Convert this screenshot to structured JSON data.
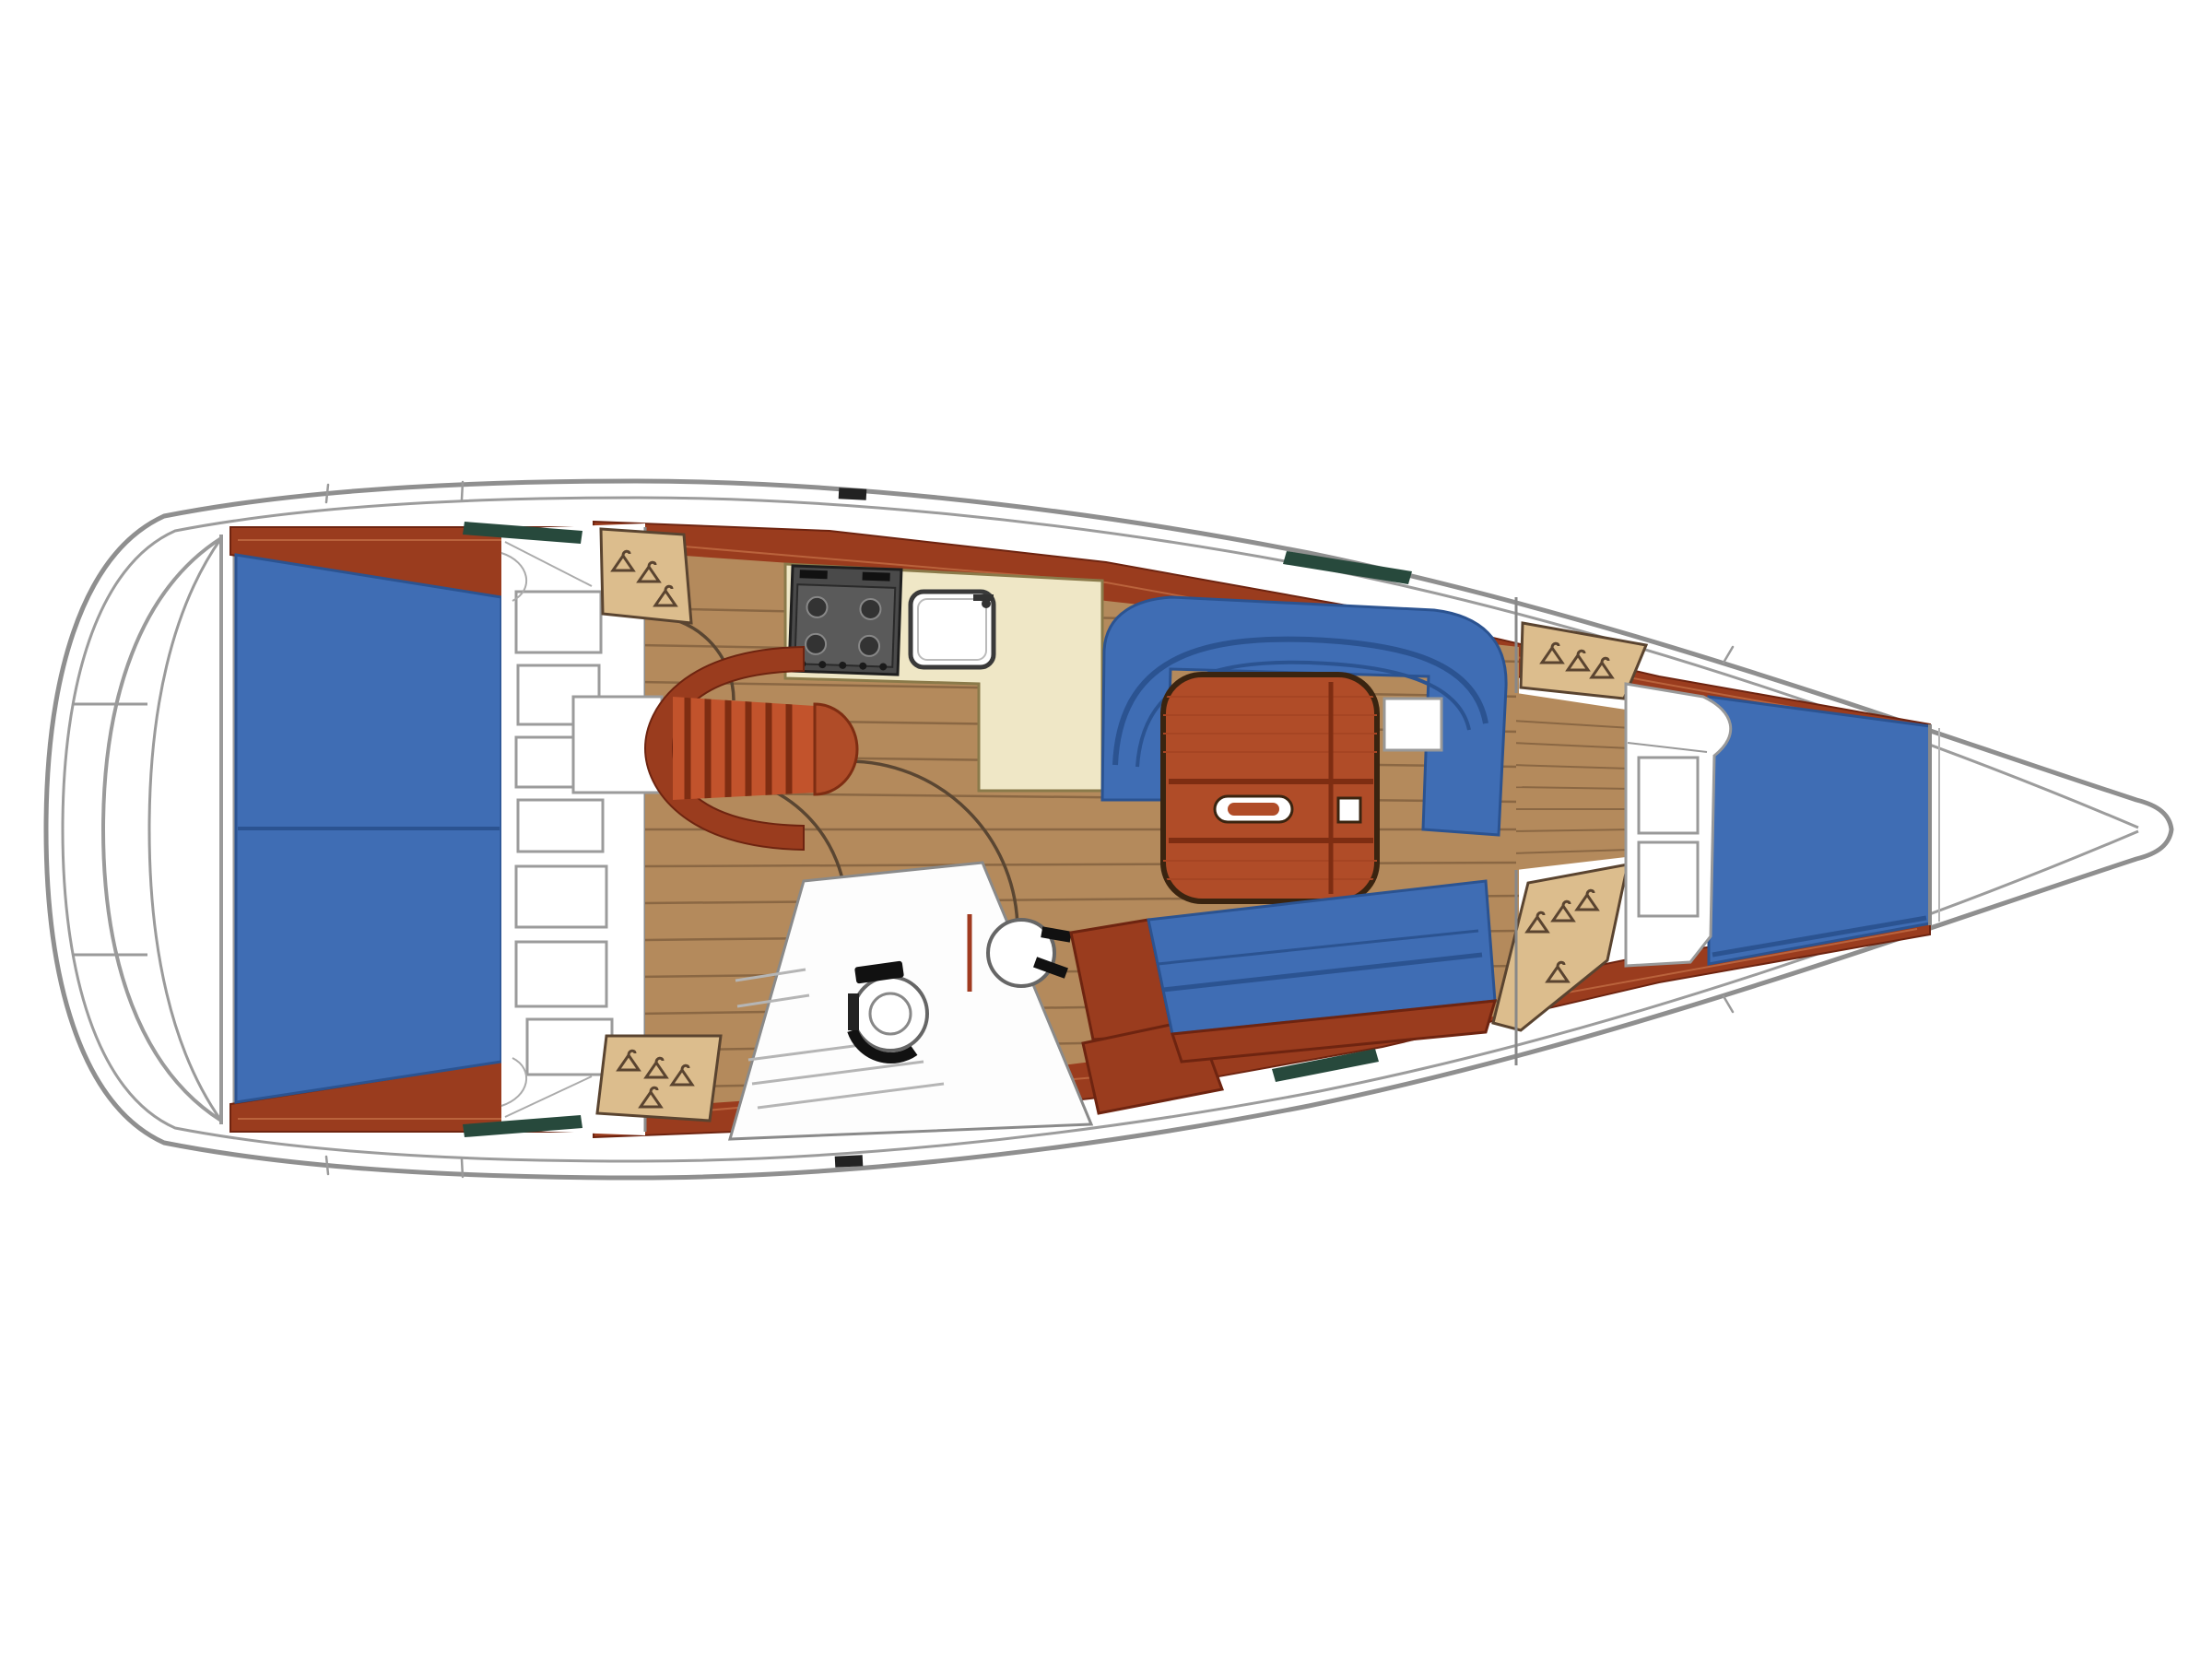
{
  "figure": {
    "type": "floor-plan",
    "subject": "sailing-yacht-interior-layout-top-view-bow-right",
    "areas": [
      "swim-platform",
      "aft-double-cabin",
      "aft-cabin-lockers",
      "wardrobe-port-aft",
      "galley",
      "stove",
      "sink",
      "companionway-steps",
      "saloon-sole",
      "u-settee-port",
      "saloon-table",
      "settee-starboard",
      "heads-compartment",
      "toilet",
      "washbasin",
      "shower-floor",
      "wardrobe-forward-port",
      "wardrobe-forward-starboard",
      "forward-cabin-seat",
      "v-berth",
      "anchor-locker"
    ]
  },
  "colors": {
    "hull_outline": "#8f8f8f",
    "inner_line": "#9c9c9c",
    "deck": "#ffffff",
    "cushion": "#3f6db4",
    "cushion_dark": "#2b5391",
    "trim": "#9a3c1e",
    "trim_dark": "#6e2410",
    "trim_streak": "#c06a42",
    "sole": "#b48a5c",
    "sole_line": "#8a6743",
    "locker": "#dcbd8d",
    "locker_line": "#5a4430",
    "counter": "#efe7c6",
    "counter_line": "#8a7a4a",
    "stove_body": "#4a4a4a",
    "steps": "#c2532c",
    "steps_dark": "#7e2d12",
    "table": "#b04c28",
    "table_dark": "#7e2d12",
    "window": "#27493c",
    "fixture": "#5f5f5f",
    "door_arc": "#5a4632",
    "white": "#ffffff"
  }
}
